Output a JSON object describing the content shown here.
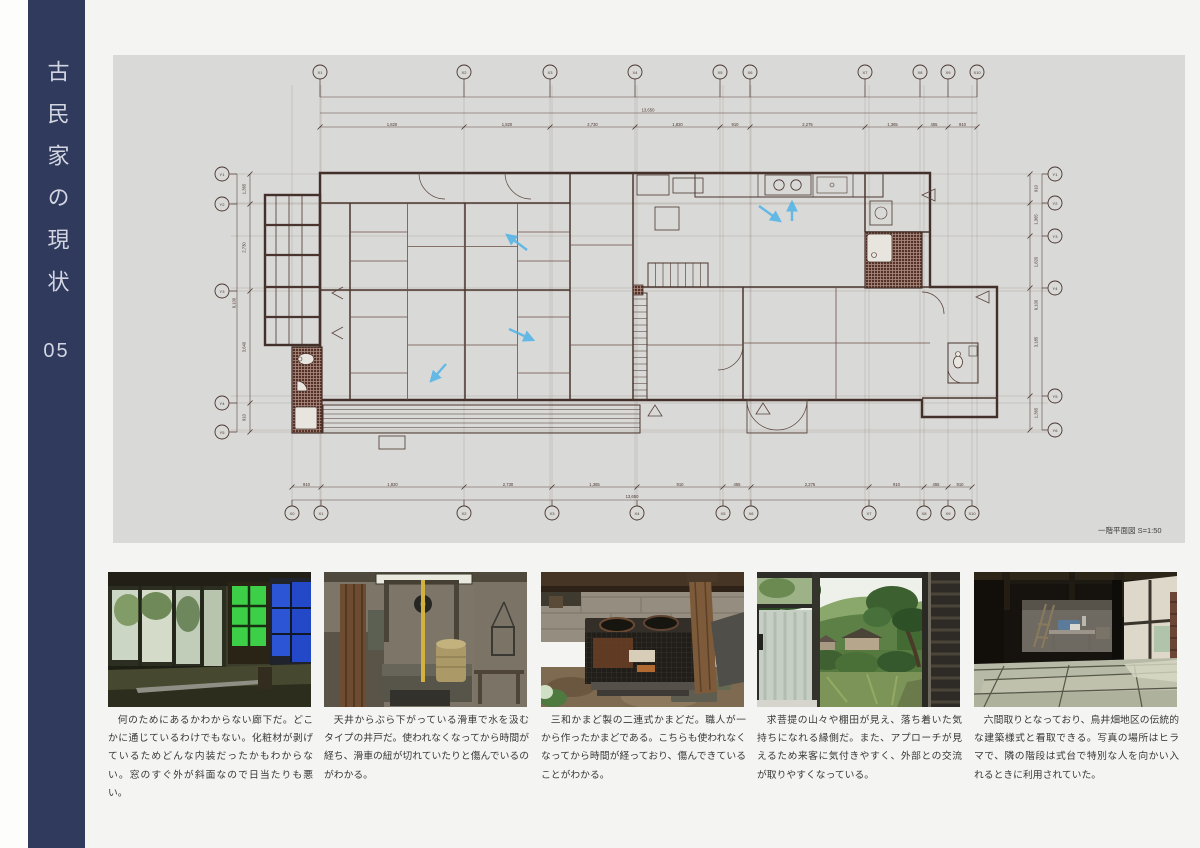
{
  "sidebar": {
    "title": "古民家の現状",
    "page_number": "05"
  },
  "plan": {
    "caption": "一階平面図 S=1:50",
    "grid_labels_top": [
      "X1",
      "X2",
      "X3",
      "X4",
      "X5",
      "X6",
      "X7",
      "X8",
      "X9",
      "X10"
    ],
    "grid_labels_bottom": [
      "X0",
      "X1",
      "X2",
      "X3",
      "X4",
      "X5",
      "X6",
      "X7",
      "X8",
      "X9",
      "X10"
    ],
    "grid_labels_left": [
      "Y1",
      "Y2",
      "Y3",
      "Y4",
      "Y5"
    ],
    "grid_labels_right": [
      "Y1",
      "Y2",
      "Y3",
      "Y4",
      "Y5",
      "Y6"
    ],
    "dims_top": [
      "1,820",
      "1,820",
      "2,730",
      "1,820",
      "910",
      "2,275",
      "1,365",
      "455",
      "910"
    ],
    "dims_bottom": [
      "910",
      "1,820",
      "2,730",
      "1,365",
      "910",
      "455",
      "2,275",
      "910",
      "455",
      "910"
    ],
    "dims_left": [
      "1,365",
      "2,730",
      "3,640",
      "910"
    ],
    "dims_right": [
      "910",
      "1,365",
      "1,820",
      "3,185",
      "1,365"
    ],
    "total_top": "13,650",
    "total_bottom": "13,650",
    "total_left": "9,100",
    "total_right": "9,100"
  },
  "captions": [
    "何のためにあるかわからない廊下だ。どこかに通じているわけでもない。化粧材が剥げているためどんな内装だったかもわからない。窓のすぐ外が斜面なので日当たりも悪い。",
    "天井からぶら下がっている滑車で水を汲むタイプの井戸だ。使われなくなってから時間が経ち、滑車の紐が切れていたりと傷んでいるのがわかる。",
    "三和かまど製の二連式かまどだ。職人が一から作ったかまどである。こちらも使われなくなってから時間が経っており、傷んできていることがわかる。",
    "求菩提の山々や棚田が見え、落ち着いた気持ちになれる縁側だ。また、アプローチが見えるため来客に気付きやすく、外部との交流が取りやすくなっている。",
    "六間取りとなっており、鳥井畑地区の伝統的な建築様式と看取できる。写真の場所はヒラマで、隣の階段は式台で特別な人を向かい入れるときに利用されていた。"
  ]
}
